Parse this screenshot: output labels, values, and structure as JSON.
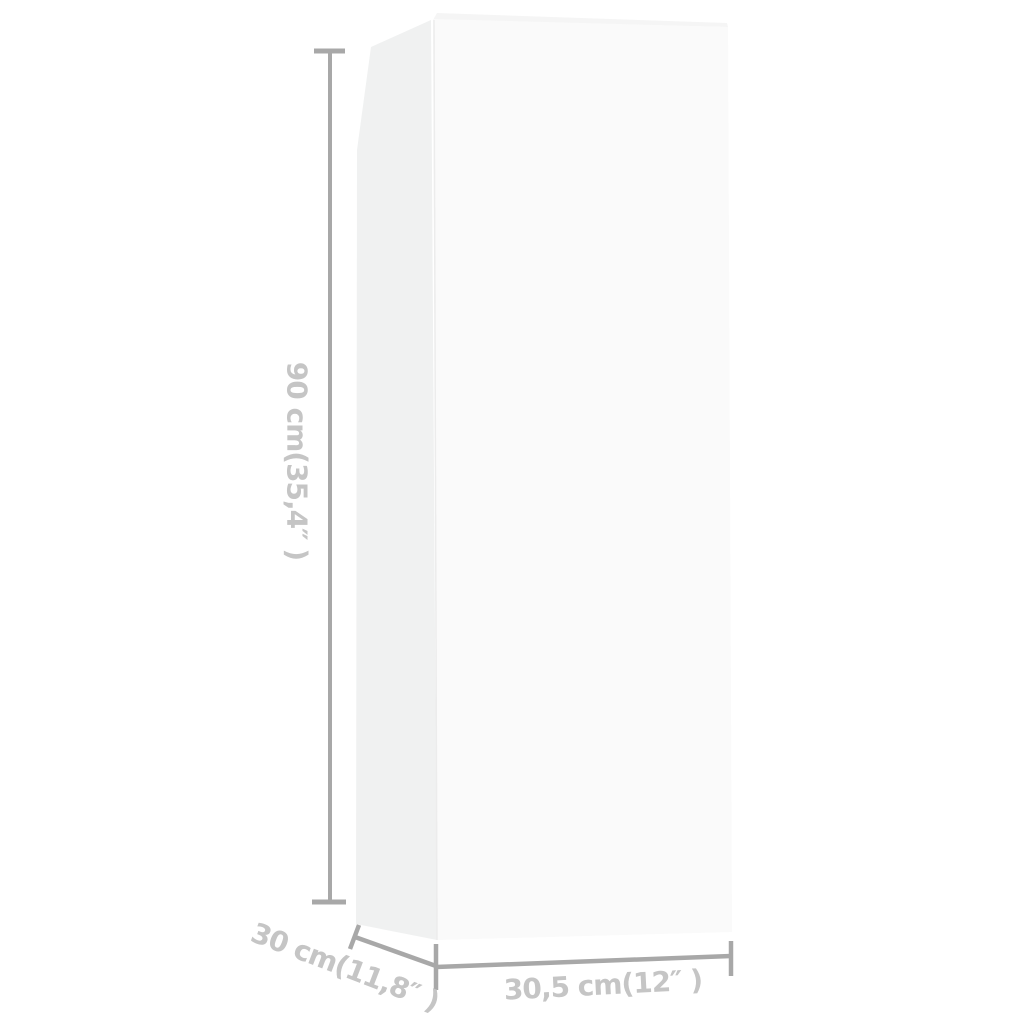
{
  "dimensions": {
    "height": {
      "label": "90 cm(35,4″ )",
      "cm": "90",
      "inches": "35,4"
    },
    "depth": {
      "label": "30 cm(11,8″ )",
      "cm": "30",
      "inches": "11,8"
    },
    "width": {
      "label": "30,5 cm(12″ )",
      "cm": "30,5",
      "inches": "12"
    }
  },
  "colors": {
    "background": "#ffffff",
    "measure_line": "#a8a8a8",
    "measure_text": "#c5c5c5",
    "cabinet_front": "#fafafa",
    "cabinet_side": "#f0f1f1",
    "cabinet_top": "#f5f5f5",
    "cabinet_edge": "#ececec"
  }
}
